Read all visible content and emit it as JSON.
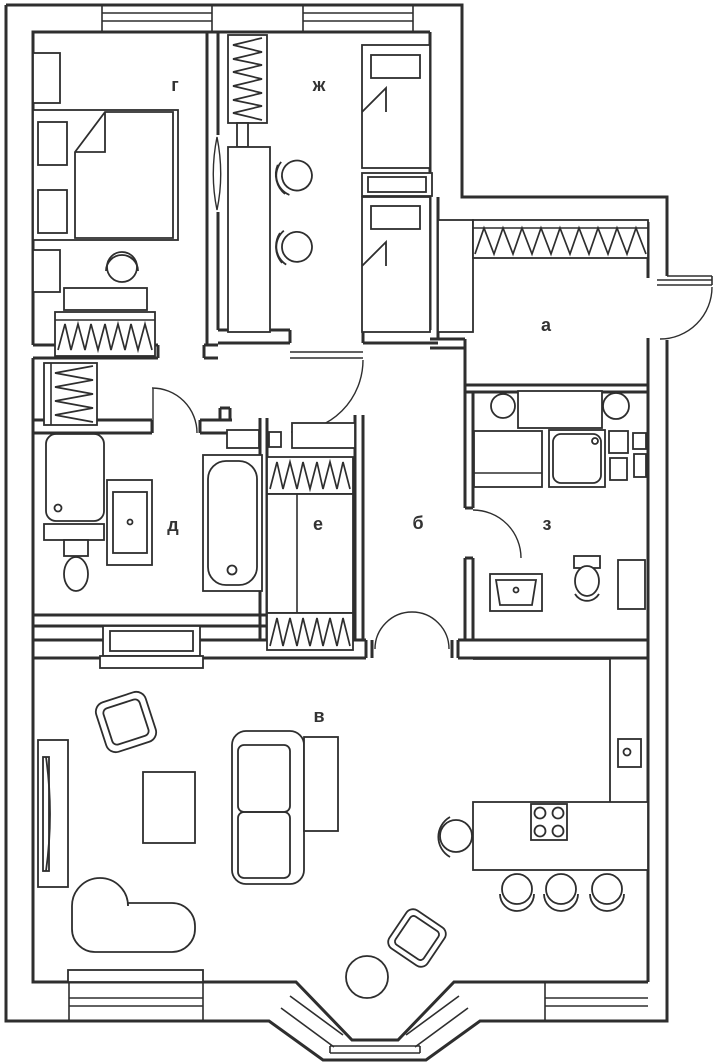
{
  "plan": {
    "type": "apartment-floor-plan",
    "colors": {
      "line": "#2e2e2e",
      "label": "#333333",
      "background": "#ffffff"
    },
    "rooms": [
      {
        "id": "room-g",
        "label": "г"
      },
      {
        "id": "room-zh",
        "label": "ж"
      },
      {
        "id": "room-a",
        "label": "а"
      },
      {
        "id": "room-d",
        "label": "д"
      },
      {
        "id": "room-e",
        "label": "е"
      },
      {
        "id": "room-b",
        "label": "б"
      },
      {
        "id": "room-z",
        "label": "з"
      },
      {
        "id": "room-v",
        "label": "в"
      }
    ]
  }
}
